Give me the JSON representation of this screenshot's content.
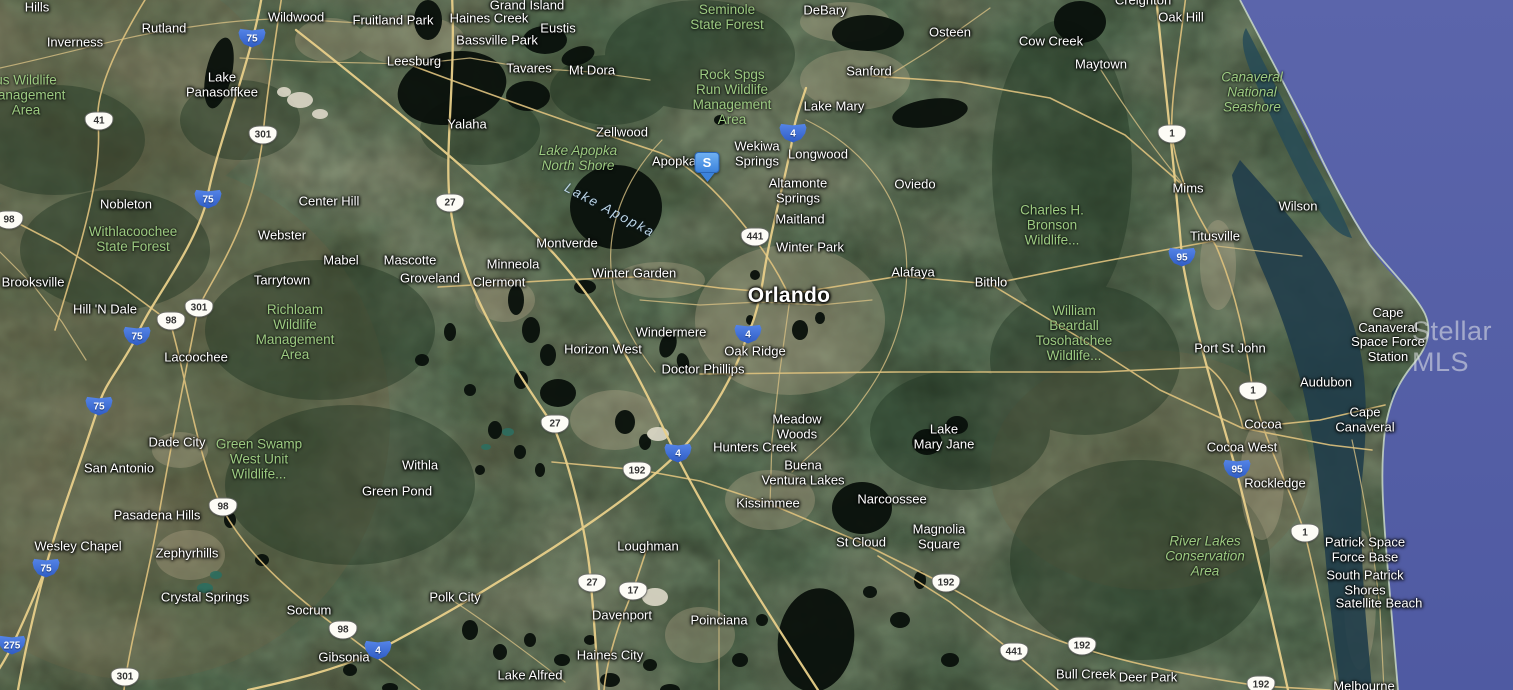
{
  "map": {
    "view_type": "satellite",
    "watermark": "Stellar MLS",
    "marker": {
      "label": "S",
      "x": 707,
      "y": 152,
      "color": "#3c83dc"
    },
    "colors": {
      "ocean": "#5661a8",
      "lagoon": "#213d4a",
      "land": "#47523b",
      "road": "#e8cf8a",
      "lake": "#0a110c",
      "city_label": "#ffffff",
      "area_label": "#9dcb82",
      "water_label": "#bdd6e8",
      "interstate_shield": "#2f5cc4",
      "us_shield": "#fdfcf6"
    },
    "labels": [
      {
        "text": "Hills",
        "x": 37,
        "y": 8,
        "k": "c"
      },
      {
        "text": "Rutland",
        "x": 164,
        "y": 29,
        "k": "c"
      },
      {
        "text": "Inverness",
        "x": 75,
        "y": 43,
        "k": "c"
      },
      {
        "text": "Wildwood",
        "x": 296,
        "y": 18,
        "k": "c"
      },
      {
        "text": "Fruitland Park",
        "x": 393,
        "y": 21,
        "k": "c"
      },
      {
        "text": "Grand Island",
        "x": 527,
        "y": 6,
        "k": "c"
      },
      {
        "text": "Haines Creek",
        "x": 489,
        "y": 19,
        "k": "c"
      },
      {
        "text": "Eustis",
        "x": 558,
        "y": 29,
        "k": "c"
      },
      {
        "text": "Bassville Park",
        "x": 497,
        "y": 41,
        "k": "c"
      },
      {
        "text": "Leesburg",
        "x": 414,
        "y": 62,
        "k": "c"
      },
      {
        "text": "Tavares",
        "x": 529,
        "y": 69,
        "k": "c"
      },
      {
        "text": "Mt Dora",
        "x": 592,
        "y": 71,
        "k": "c"
      },
      {
        "text": "Yalaha",
        "x": 467,
        "y": 125,
        "k": "c"
      },
      {
        "text": "Zellwood",
        "x": 622,
        "y": 133,
        "k": "c"
      },
      {
        "text": "DeBary",
        "x": 825,
        "y": 11,
        "k": "c"
      },
      {
        "text": "Sanford",
        "x": 869,
        "y": 72,
        "k": "c"
      },
      {
        "text": "Lake Mary",
        "x": 834,
        "y": 107,
        "k": "c"
      },
      {
        "text": "Osteen",
        "x": 950,
        "y": 33,
        "k": "c"
      },
      {
        "text": "Cow Creek",
        "x": 1051,
        "y": 42,
        "k": "c"
      },
      {
        "text": "Maytown",
        "x": 1101,
        "y": 65,
        "k": "c"
      },
      {
        "text": "Creighton",
        "x": 1143,
        "y": 1,
        "k": "c"
      },
      {
        "text": "Oak Hill",
        "x": 1181,
        "y": 18,
        "k": "c"
      },
      {
        "text": "Lake\nPanasoffkee",
        "x": 222,
        "y": 85,
        "k": "c"
      },
      {
        "text": "Nobleton",
        "x": 126,
        "y": 205,
        "k": "c"
      },
      {
        "text": "Center Hill",
        "x": 329,
        "y": 202,
        "k": "c"
      },
      {
        "text": "Webster",
        "x": 282,
        "y": 236,
        "k": "c"
      },
      {
        "text": "Mabel",
        "x": 341,
        "y": 261,
        "k": "c"
      },
      {
        "text": "Mascotte",
        "x": 410,
        "y": 261,
        "k": "c"
      },
      {
        "text": "Tarrytown",
        "x": 282,
        "y": 281,
        "k": "c"
      },
      {
        "text": "Brooksville",
        "x": 33,
        "y": 283,
        "k": "c"
      },
      {
        "text": "Hill 'N Dale",
        "x": 105,
        "y": 310,
        "k": "c"
      },
      {
        "text": "Lacoochee",
        "x": 196,
        "y": 358,
        "k": "c"
      },
      {
        "text": "Apopka",
        "x": 674,
        "y": 162,
        "k": "c"
      },
      {
        "text": "Wekiwa\nSprings",
        "x": 757,
        "y": 154,
        "k": "c"
      },
      {
        "text": "Longwood",
        "x": 818,
        "y": 155,
        "k": "c"
      },
      {
        "text": "Altamonte\nSprings",
        "x": 798,
        "y": 191,
        "k": "c"
      },
      {
        "text": "Oviedo",
        "x": 915,
        "y": 185,
        "k": "c"
      },
      {
        "text": "Maitland",
        "x": 800,
        "y": 220,
        "k": "c"
      },
      {
        "text": "Winter Park",
        "x": 810,
        "y": 248,
        "k": "c"
      },
      {
        "text": "Montverde",
        "x": 567,
        "y": 244,
        "k": "c"
      },
      {
        "text": "Minneola",
        "x": 513,
        "y": 265,
        "k": "c"
      },
      {
        "text": "Groveland",
        "x": 430,
        "y": 279,
        "k": "c"
      },
      {
        "text": "Clermont",
        "x": 499,
        "y": 283,
        "k": "c"
      },
      {
        "text": "Winter Garden",
        "x": 634,
        "y": 274,
        "k": "c"
      },
      {
        "text": "Orlando",
        "x": 789,
        "y": 296,
        "k": "cl"
      },
      {
        "text": "Alafaya",
        "x": 913,
        "y": 273,
        "k": "c"
      },
      {
        "text": "Bithlo",
        "x": 991,
        "y": 283,
        "k": "c"
      },
      {
        "text": "Mims",
        "x": 1188,
        "y": 189,
        "k": "c"
      },
      {
        "text": "Wilson",
        "x": 1298,
        "y": 207,
        "k": "c"
      },
      {
        "text": "Titusville",
        "x": 1215,
        "y": 237,
        "k": "c"
      },
      {
        "text": "Windermere",
        "x": 671,
        "y": 333,
        "k": "c"
      },
      {
        "text": "Horizon West",
        "x": 603,
        "y": 350,
        "k": "c"
      },
      {
        "text": "Oak Ridge",
        "x": 755,
        "y": 352,
        "k": "c"
      },
      {
        "text": "Doctor Phillips",
        "x": 703,
        "y": 370,
        "k": "c"
      },
      {
        "text": "Port St John",
        "x": 1230,
        "y": 349,
        "k": "c"
      },
      {
        "text": "Cape\nCanaveral\nSpace Force\nStation",
        "x": 1388,
        "y": 335,
        "k": "c"
      },
      {
        "text": "Audubon",
        "x": 1326,
        "y": 383,
        "k": "c"
      },
      {
        "text": "Meadow\nWoods",
        "x": 797,
        "y": 427,
        "k": "c"
      },
      {
        "text": "Lake\nMary Jane",
        "x": 944,
        "y": 437,
        "k": "c"
      },
      {
        "text": "Hunters Creek",
        "x": 755,
        "y": 448,
        "k": "c"
      },
      {
        "text": "Buena\nVentura Lakes",
        "x": 803,
        "y": 473,
        "k": "c"
      },
      {
        "text": "Narcoossee",
        "x": 892,
        "y": 500,
        "k": "c"
      },
      {
        "text": "Kissimmee",
        "x": 768,
        "y": 504,
        "k": "c"
      },
      {
        "text": "Magnolia\nSquare",
        "x": 939,
        "y": 537,
        "k": "c"
      },
      {
        "text": "St Cloud",
        "x": 861,
        "y": 543,
        "k": "c"
      },
      {
        "text": "Cocoa",
        "x": 1263,
        "y": 425,
        "k": "c"
      },
      {
        "text": "Cape\nCanaveral",
        "x": 1365,
        "y": 420,
        "k": "c"
      },
      {
        "text": "Cocoa West",
        "x": 1242,
        "y": 448,
        "k": "c"
      },
      {
        "text": "Rockledge",
        "x": 1275,
        "y": 484,
        "k": "c"
      },
      {
        "text": "Dade City",
        "x": 177,
        "y": 443,
        "k": "c"
      },
      {
        "text": "San Antonio",
        "x": 119,
        "y": 469,
        "k": "c"
      },
      {
        "text": "Pasadena Hills",
        "x": 157,
        "y": 516,
        "k": "c"
      },
      {
        "text": "Wesley Chapel",
        "x": 78,
        "y": 547,
        "k": "c"
      },
      {
        "text": "Zephyrhills",
        "x": 187,
        "y": 554,
        "k": "c"
      },
      {
        "text": "Withla",
        "x": 420,
        "y": 466,
        "k": "c"
      },
      {
        "text": "Green Pond",
        "x": 397,
        "y": 492,
        "k": "c"
      },
      {
        "text": "Crystal Springs",
        "x": 205,
        "y": 598,
        "k": "c"
      },
      {
        "text": "Socrum",
        "x": 309,
        "y": 611,
        "k": "c"
      },
      {
        "text": "Gibsonia",
        "x": 344,
        "y": 658,
        "k": "c"
      },
      {
        "text": "Polk City",
        "x": 455,
        "y": 598,
        "k": "c"
      },
      {
        "text": "Loughman",
        "x": 648,
        "y": 547,
        "k": "c"
      },
      {
        "text": "Davenport",
        "x": 622,
        "y": 616,
        "k": "c"
      },
      {
        "text": "Poinciana",
        "x": 719,
        "y": 621,
        "k": "c"
      },
      {
        "text": "Haines City",
        "x": 610,
        "y": 656,
        "k": "c"
      },
      {
        "text": "Lake Alfred",
        "x": 530,
        "y": 676,
        "k": "c"
      },
      {
        "text": "Bull Creek",
        "x": 1086,
        "y": 675,
        "k": "c"
      },
      {
        "text": "Deer Park",
        "x": 1148,
        "y": 678,
        "k": "c"
      },
      {
        "text": "Melbourne",
        "x": 1364,
        "y": 687,
        "k": "c"
      },
      {
        "text": "Patrick Space\nForce Base",
        "x": 1365,
        "y": 550,
        "k": "c"
      },
      {
        "text": "South Patrick\nShores",
        "x": 1365,
        "y": 583,
        "k": "c"
      },
      {
        "text": "Satellite Beach",
        "x": 1379,
        "y": 604,
        "k": "c"
      },
      {
        "text": "us Wildlife\nManagement\nArea",
        "x": 26,
        "y": 95,
        "k": "a"
      },
      {
        "text": "Seminole\nState Forest",
        "x": 727,
        "y": 17,
        "k": "a"
      },
      {
        "text": "Rock Spgs\nRun Wildlife\nManagement\nArea",
        "x": 732,
        "y": 97,
        "k": "a"
      },
      {
        "text": "Withlacoochee\nState Forest",
        "x": 133,
        "y": 239,
        "k": "a"
      },
      {
        "text": "Richloam\nWildlife\nManagement\nArea",
        "x": 295,
        "y": 332,
        "k": "a"
      },
      {
        "text": "Charles H.\nBronson\nWildlife...",
        "x": 1052,
        "y": 225,
        "k": "a"
      },
      {
        "text": "William\nBeardall\nTosohatchee\nWildlife...",
        "x": 1074,
        "y": 333,
        "k": "a"
      },
      {
        "text": "Green Swamp\nWest Unit\nWildlife...",
        "x": 259,
        "y": 459,
        "k": "a"
      },
      {
        "text": "Lake Apopka\nNorth Shore",
        "x": 578,
        "y": 158,
        "k": "ai"
      },
      {
        "text": "Canaveral\nNational\nSeashore",
        "x": 1252,
        "y": 92,
        "k": "ai"
      },
      {
        "text": "River Lakes\nConservation\nArea",
        "x": 1205,
        "y": 556,
        "k": "ai"
      },
      {
        "text": "Lake Apopka",
        "x": 610,
        "y": 210,
        "k": "w",
        "rot": 28
      }
    ],
    "shields": [
      {
        "n": "75",
        "t": "i",
        "x": 252,
        "y": 38
      },
      {
        "n": "75",
        "t": "i",
        "x": 208,
        "y": 199
      },
      {
        "n": "75",
        "t": "i",
        "x": 137,
        "y": 336
      },
      {
        "n": "75",
        "t": "i",
        "x": 99,
        "y": 406
      },
      {
        "n": "75",
        "t": "i",
        "x": 46,
        "y": 568
      },
      {
        "n": "275",
        "t": "i",
        "x": 12,
        "y": 645
      },
      {
        "n": "4",
        "t": "i",
        "x": 793,
        "y": 133
      },
      {
        "n": "4",
        "t": "i",
        "x": 748,
        "y": 334
      },
      {
        "n": "4",
        "t": "i",
        "x": 678,
        "y": 453
      },
      {
        "n": "4",
        "t": "i",
        "x": 378,
        "y": 650
      },
      {
        "n": "95",
        "t": "i",
        "x": 1182,
        "y": 257
      },
      {
        "n": "95",
        "t": "i",
        "x": 1237,
        "y": 469
      },
      {
        "n": "41",
        "t": "u",
        "x": 99,
        "y": 121
      },
      {
        "n": "301",
        "t": "u",
        "x": 263,
        "y": 135
      },
      {
        "n": "301",
        "t": "u",
        "x": 199,
        "y": 308
      },
      {
        "n": "301",
        "t": "u",
        "x": 125,
        "y": 677
      },
      {
        "n": "98",
        "t": "u",
        "x": 9,
        "y": 220
      },
      {
        "n": "98",
        "t": "u",
        "x": 171,
        "y": 321
      },
      {
        "n": "98",
        "t": "u",
        "x": 223,
        "y": 507
      },
      {
        "n": "98",
        "t": "u",
        "x": 343,
        "y": 630
      },
      {
        "n": "27",
        "t": "u",
        "x": 450,
        "y": 203
      },
      {
        "n": "27",
        "t": "u",
        "x": 555,
        "y": 424
      },
      {
        "n": "27",
        "t": "u",
        "x": 592,
        "y": 583
      },
      {
        "n": "441",
        "t": "u",
        "x": 755,
        "y": 237
      },
      {
        "n": "441",
        "t": "u",
        "x": 1014,
        "y": 652
      },
      {
        "n": "192",
        "t": "u",
        "x": 637,
        "y": 471
      },
      {
        "n": "192",
        "t": "u",
        "x": 946,
        "y": 583
      },
      {
        "n": "192",
        "t": "u",
        "x": 1082,
        "y": 646
      },
      {
        "n": "192",
        "t": "u",
        "x": 1261,
        "y": 685
      },
      {
        "n": "17",
        "t": "u",
        "x": 633,
        "y": 591
      },
      {
        "n": "1",
        "t": "u",
        "x": 1172,
        "y": 134
      },
      {
        "n": "1",
        "t": "u",
        "x": 1253,
        "y": 391
      },
      {
        "n": "1",
        "t": "u",
        "x": 1305,
        "y": 533
      }
    ]
  }
}
